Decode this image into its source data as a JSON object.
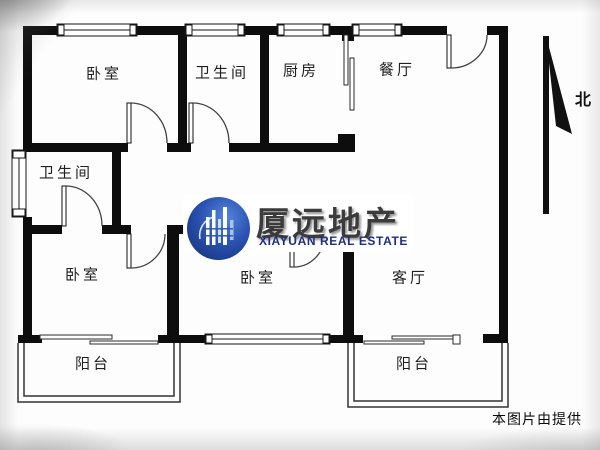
{
  "image": {
    "type": "floorplan",
    "width": 600,
    "height": 450
  },
  "rooms": [
    {
      "id": "bedroom-top-left",
      "label": "卧室"
    },
    {
      "id": "bathroom-top",
      "label": "卫生间"
    },
    {
      "id": "kitchen",
      "label": "厨房"
    },
    {
      "id": "dining-room",
      "label": "餐厅"
    },
    {
      "id": "bathroom-left",
      "label": "卫生间"
    },
    {
      "id": "bedroom-bottom-left",
      "label": "卧室"
    },
    {
      "id": "bedroom-bottom-middle",
      "label": "卧室"
    },
    {
      "id": "living-room",
      "label": "客厅"
    },
    {
      "id": "balcony-left",
      "label": "阳台"
    },
    {
      "id": "balcony-right",
      "label": "阳台"
    }
  ],
  "compass": {
    "label": "北"
  },
  "watermark": {
    "brand_cn": "厦远地产",
    "brand_en": "XIAYUAN REAL ESTATE"
  },
  "footer": {
    "credit": "本图片由提供"
  },
  "colors": {
    "wall": "#0d0d0d",
    "thin_line": "#3a3a3a",
    "logo_circle_dark": "#132c74",
    "logo_circle_light": "#5585e0",
    "logo_text_cn": "#3b3b3b",
    "logo_text_en": "#1d2f7f"
  }
}
